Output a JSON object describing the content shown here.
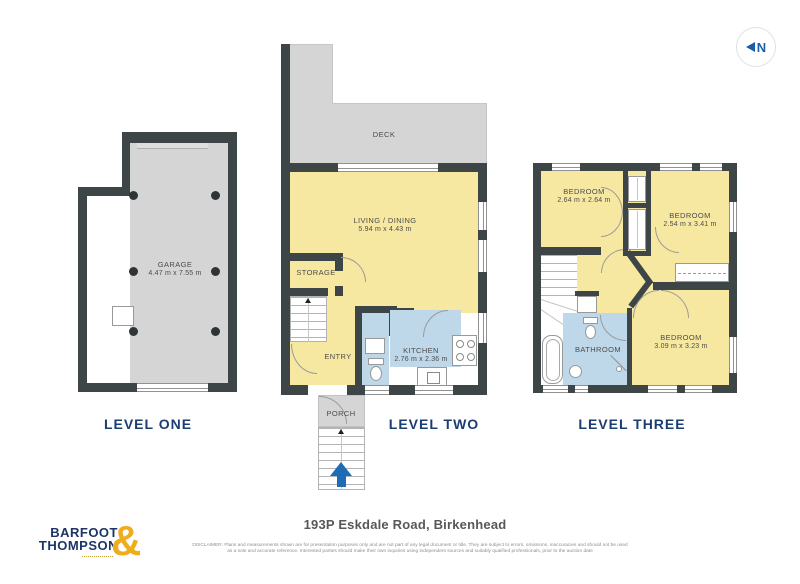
{
  "compass": {
    "label": "N"
  },
  "levels": [
    {
      "label": "LEVEL ONE",
      "rooms": [
        {
          "name": "GARAGE",
          "dims": "4.47 m x 7.55 m"
        }
      ]
    },
    {
      "label": "LEVEL TWO",
      "rooms": [
        {
          "name": "DECK"
        },
        {
          "name": "LIVING / DINING",
          "dims": "5.94 m x 4.43 m"
        },
        {
          "name": "STORAGE"
        },
        {
          "name": "ENTRY"
        },
        {
          "name": "KITCHEN",
          "dims": "2.76 m x 2.36 m"
        },
        {
          "name": "PORCH"
        }
      ]
    },
    {
      "label": "LEVEL THREE",
      "rooms": [
        {
          "name": "BEDROOM",
          "dims": "2.64 m x 2.64 m"
        },
        {
          "name": "BEDROOM",
          "dims": "2.54 m x 3.41 m"
        },
        {
          "name": "BATHROOM"
        },
        {
          "name": "BEDROOM",
          "dims": "3.09 m x 3.23 m"
        }
      ]
    }
  ],
  "footer": {
    "logo_line1": "BARFOOT",
    "logo_line2": "THOMPSON",
    "logo_ampersand": "&",
    "address": "193P Eskdale Road, Birkenhead",
    "disclaimer_line1": "DISCLAIMER: Plans and measurements shown are for presentation purposes only and are not part of any legal document or title. They are subject to errors, omissions, inaccuracies and should not be used",
    "disclaimer_line2": "as a sole and accurate reference. Interested parties should make their own inquiries using independent sources and suitably qualified professionals, prior to the auction date"
  },
  "colors": {
    "wall": "#3E4547",
    "room_yellow": "#F7E8A1",
    "wet_blue": "#BED8E9",
    "outdoor_gray": "#D5D5D5",
    "label_navy": "#1B3E72",
    "brand_gold": "#EFAD1E",
    "arrow_blue": "#1D6CB5"
  }
}
